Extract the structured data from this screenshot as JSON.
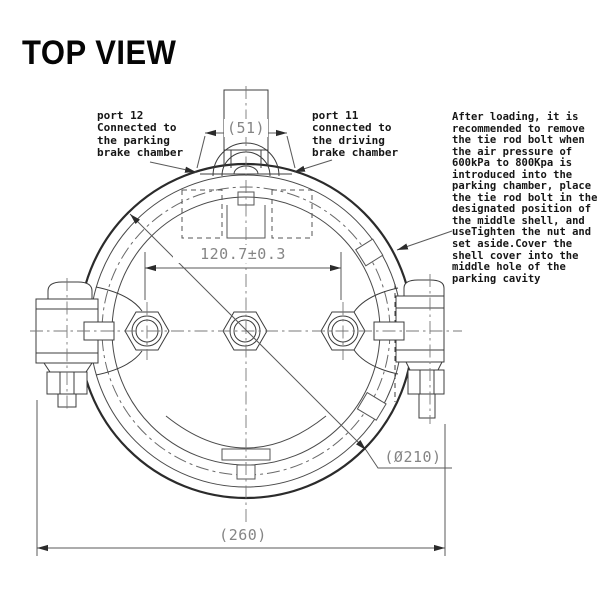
{
  "title": "TOP VIEW",
  "callouts": {
    "port12": "port 12\nConnected to\nthe parking\nbrake chamber",
    "port11": "port 11\nconnected to\nthe driving\nbrake chamber",
    "note": "After loading, it is\nrecommended to remove\nthe tie rod bolt when\nthe air pressure of\n600kPa to 800Kpa is\nintroduced into the\nparking chamber, place\nthe tie rod bolt in the\ndesignated position of\nthe middle shell, and\nuseTighten the nut and\nset aside.Cover the\nshell cover into the\nmiddle hole of the\nparking cavity"
  },
  "dimensions": {
    "port_width": "(51)",
    "bolt_spacing": "120.7±0.3",
    "shell_diameter": "(Ø210)",
    "overall_width": "(260)"
  },
  "colors": {
    "line": "#3c3c3c",
    "heavy_line": "#2b2b2b",
    "dim_line": "#5a5a5a",
    "dim_text": "#858585",
    "text": "#161616",
    "background": "#ffffff"
  }
}
